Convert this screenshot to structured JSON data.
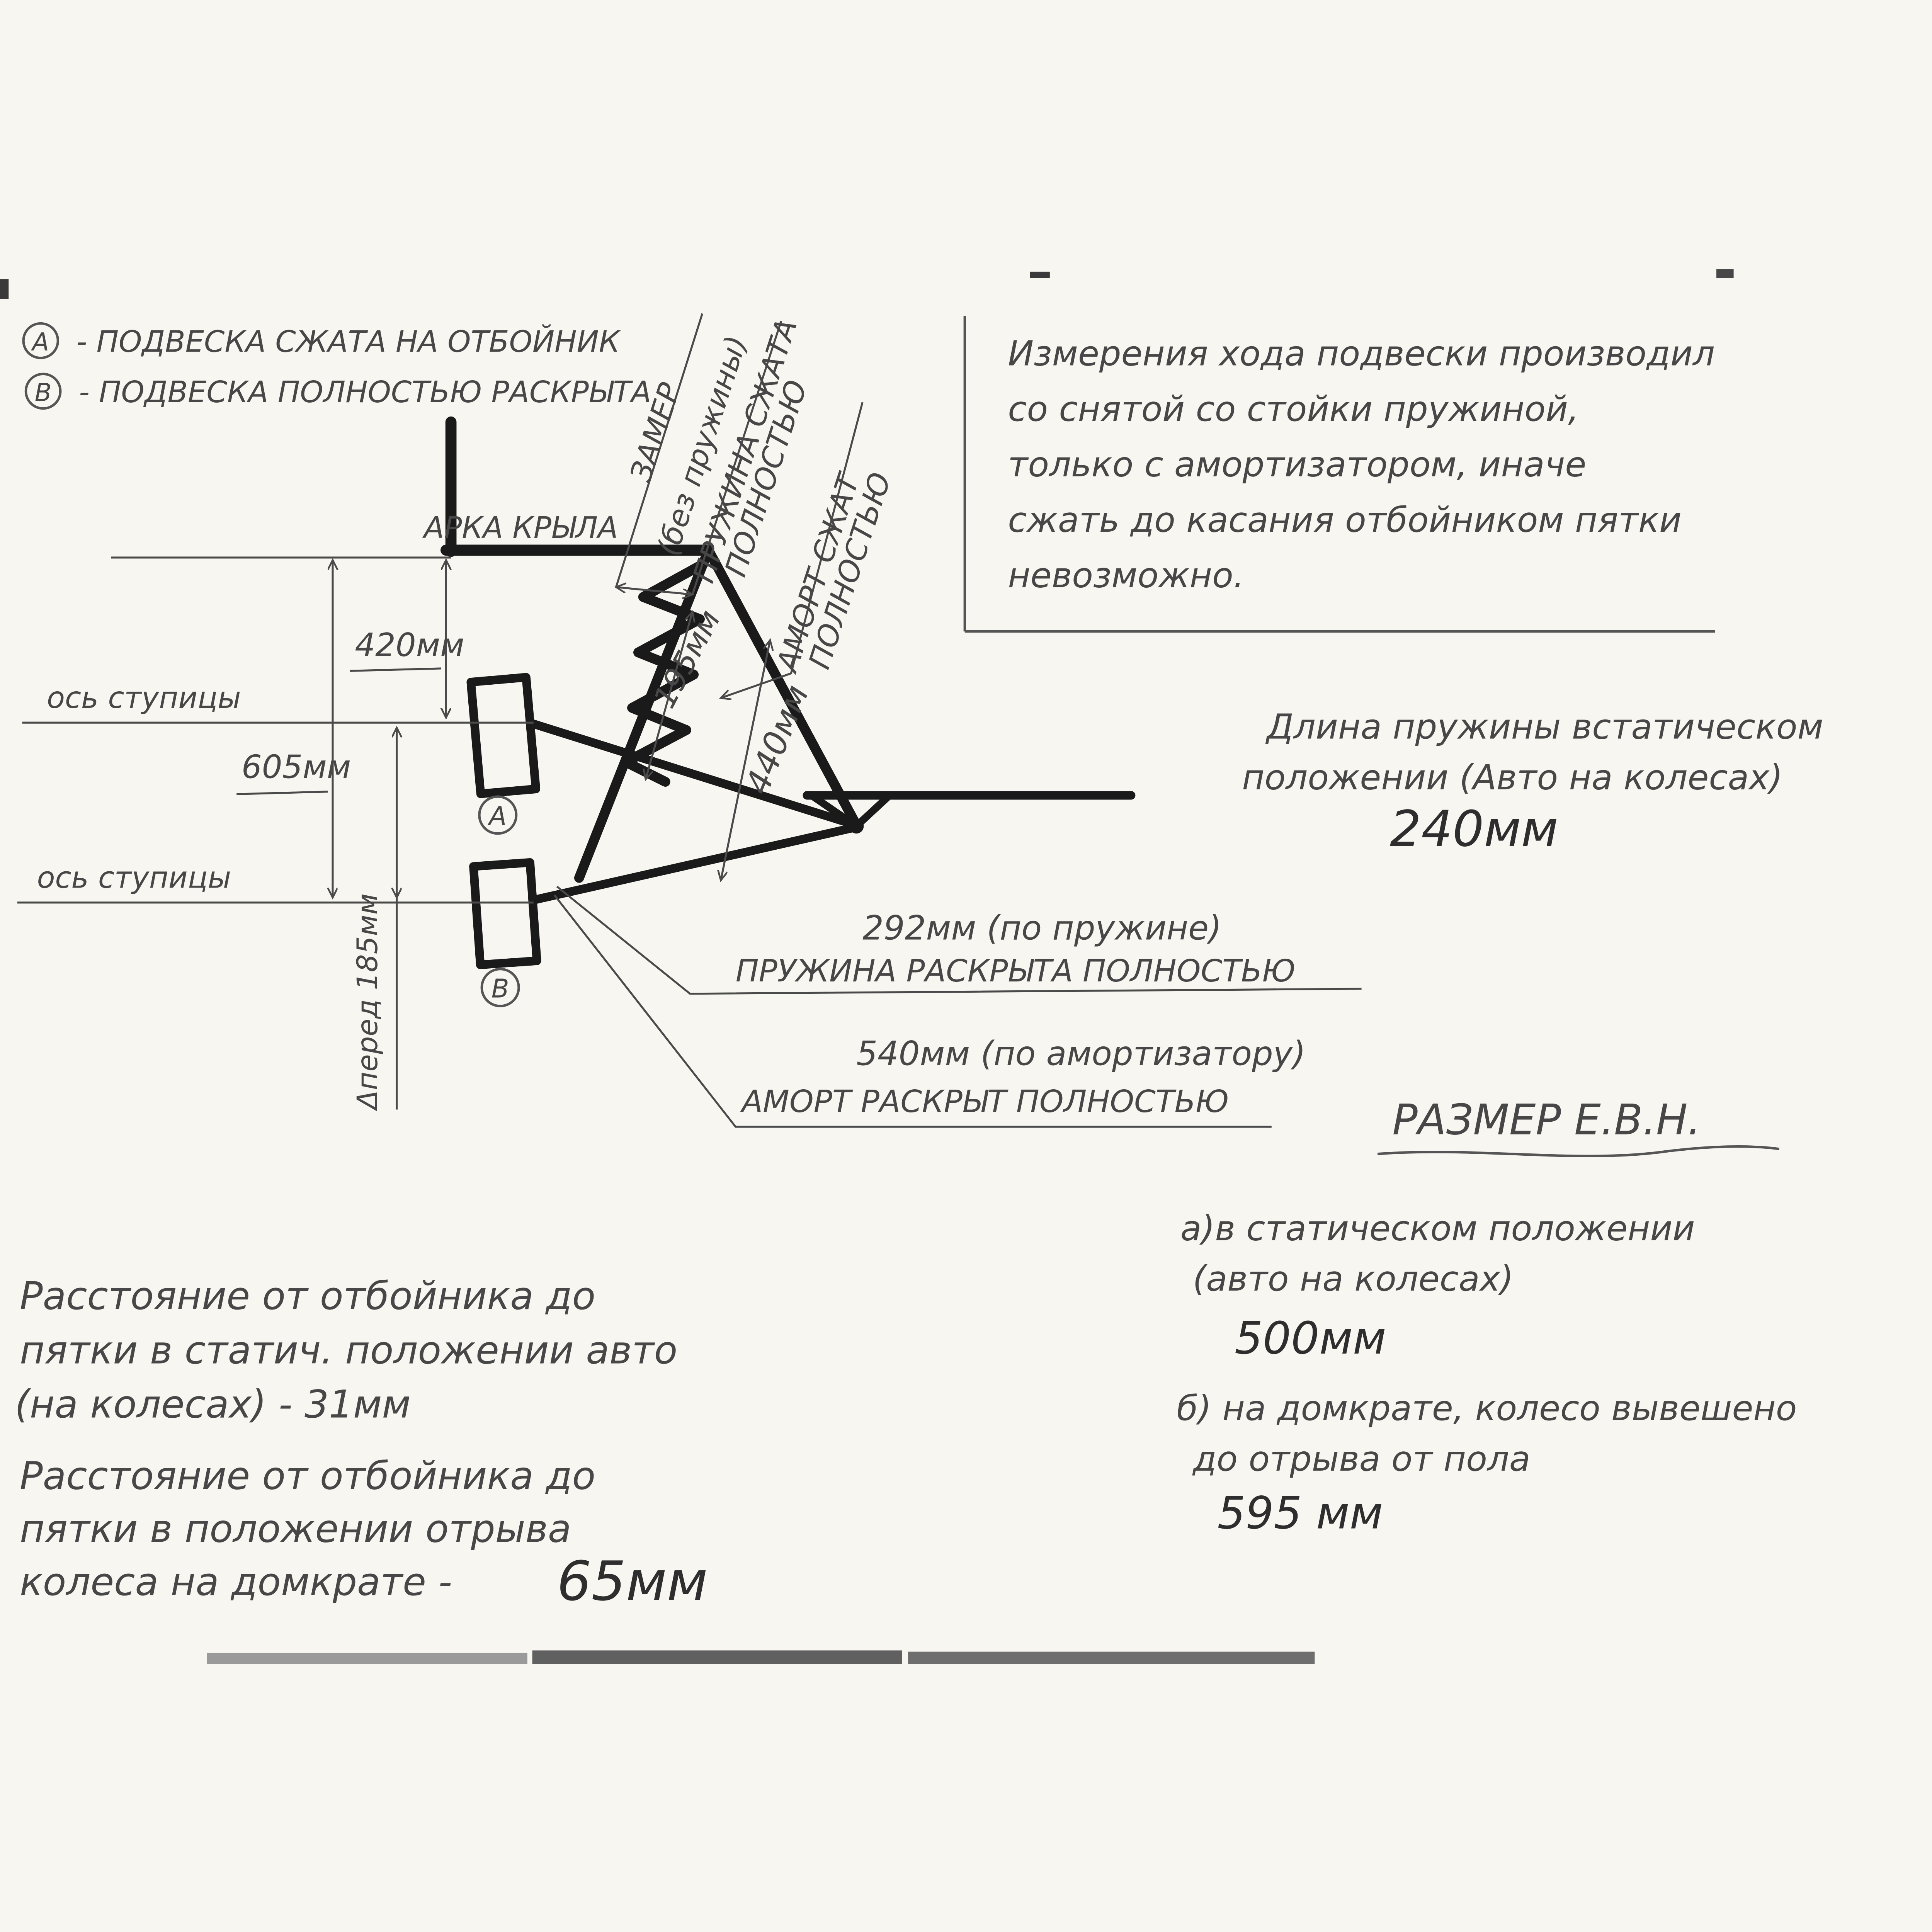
{
  "colors": {
    "paper": "#f7f6f1",
    "pencil": "#474747",
    "marker": "#1a1a1a"
  },
  "legend": {
    "a_key": "А",
    "a_text": "- ПОДВЕСКА СЖАТА НА ОТБОЙНИК",
    "b_key": "В",
    "b_text": "- ПОДВЕСКА ПОЛНОСТЬЮ РАСКРЫТА"
  },
  "note_box": {
    "lines": [
      "Измерения хода подвески производил",
      "со снятой со стойки пружиной,",
      "только с амортизатором, иначе",
      "сжать до касания отбойником пятки",
      "невозможно."
    ]
  },
  "diagram": {
    "arch_label": "АРКА КРЫЛА",
    "hub_axis_label_top": "ось ступицы",
    "hub_axis_label_bottom": "ось ступицы",
    "dim_arch_to_a": "420мм",
    "dim_arch_to_b": "605мм",
    "dim_travel": "Δперед 185мм",
    "dim_spring_compressed": "195мм",
    "dim_shock_compressed": "440мм",
    "callout_compressed": [
      "ЗАМЕР",
      "(без пружины)",
      "ПРУЖИНА СЖАТА",
      "ПОЛНОСТЬЮ"
    ],
    "callout_shock": [
      "АМОРТ СЖАТ",
      "ПОЛНОСТЬЮ"
    ],
    "wheel_a_label": "А",
    "wheel_b_label": "В",
    "spring_open": {
      "line1": "292мм (по пружине)",
      "line2": "ПРУЖИНА РАСКРЫТА ПОЛНОСТЬЮ"
    },
    "shock_open": {
      "line1": "540мм (по амортизатору)",
      "line2": "АМОРТ РАСКРЫТ ПОЛНОСТЬЮ"
    }
  },
  "spring_static": {
    "line1": "Длина пружины встатическом",
    "line2": "положении (Авто на колесах)",
    "value": "240мм"
  },
  "size_evn": {
    "title": "РАЗМЕР Е.В.Н.",
    "a_line1": "а)в статическом положении",
    "a_line2": "(авто на колесах)",
    "a_value": "500мм",
    "b_line1": "б) на домкрате, колесо вывешено",
    "b_line2": "до отрыва от пола",
    "b_value": "595 мм"
  },
  "notes_left": {
    "static": {
      "line1": "Расстояние от отбойника до",
      "line2": "пятки в статич. положении авто",
      "line3": "(на колесах)  -  31мм"
    },
    "jack": {
      "line1": "Расстояние от отбойника до",
      "line2": "пятки в положении отрыва",
      "line3": "колеса на домкрате -",
      "value": "65мм"
    }
  }
}
